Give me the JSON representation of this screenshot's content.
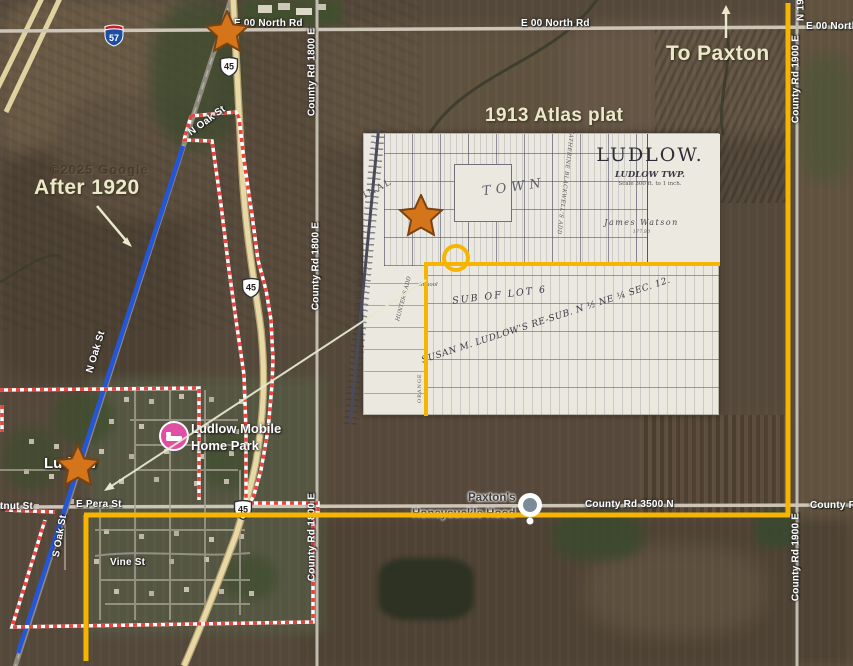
{
  "annotations": {
    "after_1920": "After 1920",
    "atlas_plat": "1913 Atlas plat",
    "to_paxton": "To Paxton"
  },
  "road_labels": {
    "e00_north_a": "E 00 North Rd",
    "e00_north_b": "E 00 North Rd",
    "e00_north_c": "E 00 North",
    "n19_fragment": "N 19",
    "cr1800_a": "County Rd 1800 E",
    "cr1800_b": "County Rd 1800 E",
    "cr1800_c": "County Rd 1800 E",
    "cr1900_a": "County Rd 1900 E",
    "cr1900_b": "County Rd 1900 E",
    "cr3500": "County Rd 3500 N",
    "cr3500_fragment": "County Rd",
    "e_pera": "E Pera St",
    "chestnut_fragment": "tnut St",
    "vine": "Vine St",
    "s_oak": "S Oak St",
    "n_oak_a": "N Oak St",
    "n_oak_b": "N Oak St"
  },
  "route_shields": {
    "interstate_57": "57",
    "us_45_a": "45",
    "us_45_b": "45",
    "us_45_c": "45"
  },
  "places": {
    "town": "Ludlow",
    "mobile_home_line1": "Ludlow Mobile",
    "mobile_home_line2": "Home Park",
    "poi_line1": "Paxton's",
    "poi_line2": "Honeysuckle Hood"
  },
  "plat": {
    "title": "LUDLOW.",
    "township": "LUDLOW TWP.",
    "scale_note": "Scale 300 ft. to 1 inch.",
    "owner": "James Watson",
    "owner_acres": "177.80",
    "town_label": "TOWN",
    "sub_of_lot": "SUB OF LOT 6",
    "susan_resub": "SUSAN M. LUDLOW'S RE-SUB. N ½ NE ¼ SEC. 12.",
    "school": "School",
    "orange_st": "ORANGE",
    "hunters_add": "HUNTER'S ADD",
    "katherine_add": "KATHERINE BLACKWELL'S ADD",
    "original_fragment": "INAL"
  },
  "watermark": "©2025 Google",
  "colors": {
    "annotation_yellow": "#F6B500",
    "railroad_blue": "#2456D6",
    "boundary_red": "#E8433E",
    "annotation_cream": "#ECE9CA",
    "star_orange": "#D4751C",
    "poi_pink": "#E04FA4"
  }
}
